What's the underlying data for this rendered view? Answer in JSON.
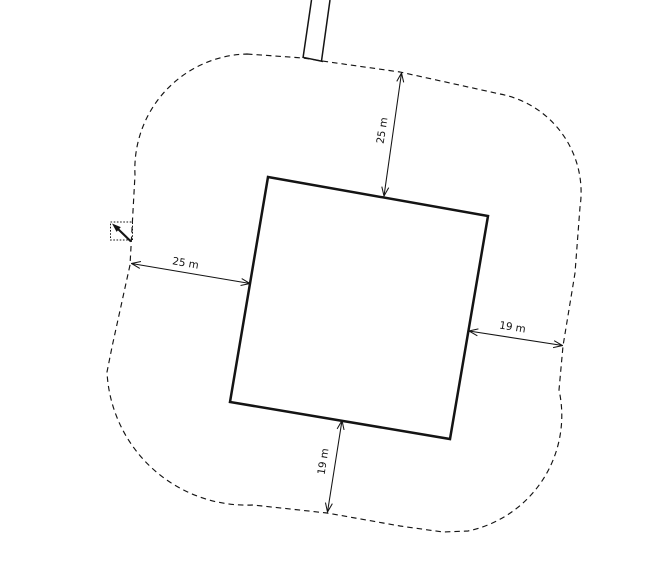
{
  "canvas": {
    "width": 645,
    "height": 574,
    "background": "#ffffff",
    "line_color": "#141414"
  },
  "site_plan": {
    "description": "Building footprint with dashed buffer boundary, four setback dimensions, road stub and select cursor",
    "buffer_boundary": {
      "path": "M247,54 L303,58 L322,61 L400,72 L500,94 A100,100 0 0 1 580,207 L575,273 L563,346 L559,390 A118,118 0 0 1 468,531 L443,532 L400,526 L327,513 L253,505 A140,140 0 0 1 107,372 L112,347 L130,265 L135,175 A115,115 0 0 1 247,54 Z",
      "dash_pattern": "5.5,4"
    },
    "road": {
      "edges_path": "M311.5,0 L303,58 M330,0 L321.5,61",
      "end_cap_path": "M302.5,57.2 L323,61.5"
    },
    "building": {
      "points": "268,177 488,216 450,439 230,402"
    },
    "dimensions": {
      "north": {
        "label": "25 m",
        "value": 25,
        "unit": "m",
        "x1": 384,
        "y1": 196,
        "x2": 401.5,
        "y2": 73,
        "label_transform": "translate(385.5,131) rotate(-81.5)"
      },
      "west": {
        "label": "25 m",
        "value": 25,
        "unit": "m",
        "x1": 250,
        "y1": 283.5,
        "x2": 131.5,
        "y2": 263.5,
        "label_transform": "translate(185,266.5) rotate(10)"
      },
      "east": {
        "label": "19 m",
        "value": 19,
        "unit": "m",
        "x1": 469,
        "y1": 331,
        "x2": 562.5,
        "y2": 345.5,
        "label_transform": "translate(512,330.5) rotate(9.2)"
      },
      "south": {
        "label": "19 m",
        "value": 19,
        "unit": "m",
        "x1": 342,
        "y1": 420.5,
        "x2": 327.5,
        "y2": 512,
        "label_transform": "translate(326.5,462) rotate(-81.3)"
      }
    },
    "cursor": {
      "box": {
        "x": 110.5,
        "y": 222,
        "width": 22,
        "height": 18,
        "dash": "1.6,1.6"
      },
      "head_path": "M112,223.5 L120.8,227.1 L116.6,231.9 Z",
      "tail": {
        "x1": 117.5,
        "y1": 228.5,
        "x2": 131,
        "y2": 241.5
      }
    }
  }
}
